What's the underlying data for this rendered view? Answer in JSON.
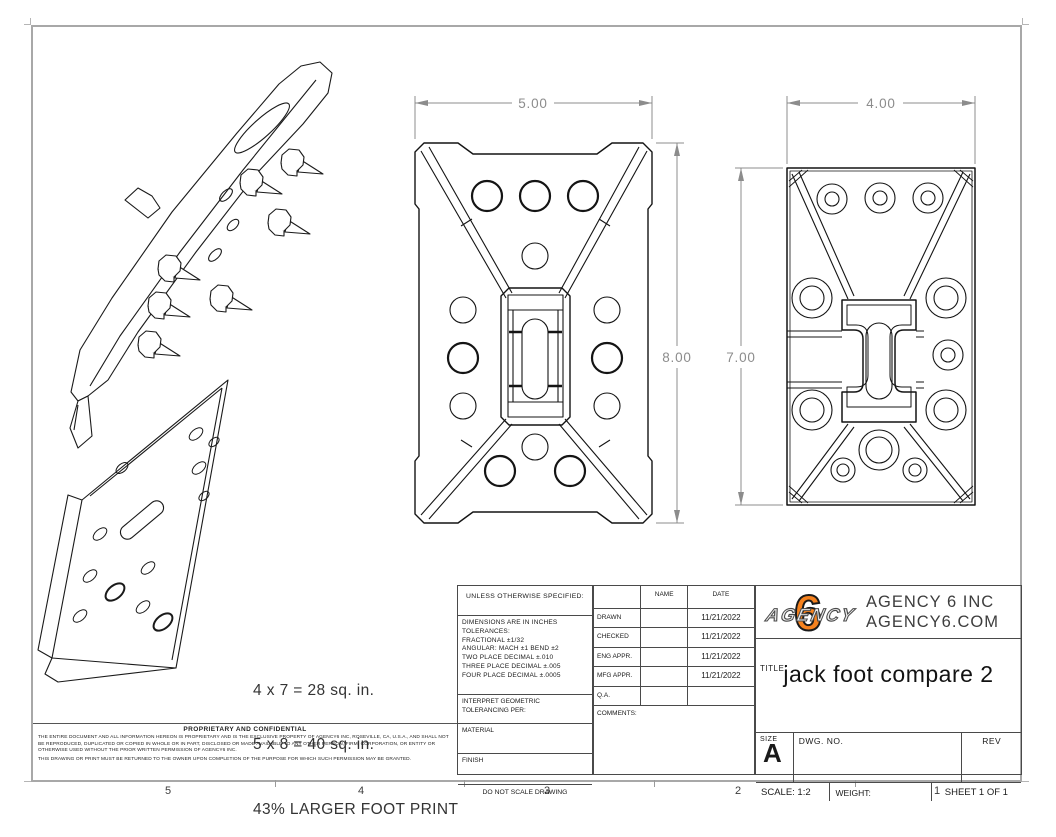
{
  "sheet": {
    "zones": [
      "5",
      "4",
      "3",
      "2",
      "1"
    ]
  },
  "dimensions": {
    "front_width": "5.00",
    "front_height": "8.00",
    "side_width": "4.00",
    "side_height": "7.00"
  },
  "annotations": {
    "line1": "4 x 7 = 28 sq. in.",
    "line2": "5 x 8 = 40 sq. in.",
    "line3": "43% LARGER FOOT PRINT"
  },
  "proprietary": {
    "title": "PROPRIETARY AND CONFIDENTIAL",
    "para1": "THE ENTIRE DOCUMENT AND ALL INFORMATION HEREON IS PROPRIETARY AND IS THE EXCLUSIVE PROPERTY OF AGENCY6 INC, ROSEVILLE, CA, U.S.A., AND SHALL NOT BE REPRODUCED, DUPLICATED OR COPIED IN WHOLE OR IN PART, DISCLOSED OR MADE AVAILABLE TO ANY OTHER PERSON, FIRM, CORPORATION, OR ENTITY OR OTHERWISE USED WITHOUT THE PRIOR WRITTEN PERMISSION OF AGENCY6 INC.",
    "para2": "THIS DRAWING OR PRINT MUST BE RETURNED TO THE OWNER UPON COMPLETION OF THE PURPOSE FOR WHICH SUCH PERMISSION MAY BE GRANTED."
  },
  "tolerance_block": {
    "header": "UNLESS OTHERWISE SPECIFIED:",
    "line1": "DIMENSIONS ARE IN INCHES",
    "line2": "TOLERANCES:",
    "line3": "FRACTIONAL ±1/32",
    "line4": "ANGULAR: MACH ±1   BEND ±2",
    "line5": "TWO PLACE DECIMAL    ±.010",
    "line6": "THREE PLACE DECIMAL  ±.005",
    "line7": "FOUR PLACE DECIMAL  ±.0005",
    "interpret1": "INTERPRET GEOMETRIC",
    "interpret2": "TOLERANCING PER:",
    "material_label": "MATERIAL",
    "finish_label": "FINISH",
    "do_not_scale": "DO NOT SCALE DRAWING"
  },
  "approval_table": {
    "name_header": "NAME",
    "date_header": "DATE",
    "rows": [
      {
        "label": "DRAWN",
        "name": "",
        "date": "11/21/2022"
      },
      {
        "label": "CHECKED",
        "name": "",
        "date": "11/21/2022"
      },
      {
        "label": "ENG APPR.",
        "name": "",
        "date": "11/21/2022"
      },
      {
        "label": "MFG APPR.",
        "name": "",
        "date": "11/21/2022"
      },
      {
        "label": "Q.A.",
        "name": "",
        "date": ""
      }
    ],
    "comments_label": "COMMENTS:"
  },
  "title_block": {
    "logo_number": "6",
    "logo_word": "AGENCY",
    "logo_orange": "#F5821F",
    "company_line1": "AGENCY 6 INC",
    "company_line2": "AGENCY6.COM",
    "title_label": "TITLE:",
    "title": "jack foot compare 2",
    "size_label": "SIZE",
    "size_value": "A",
    "dwg_label": "DWG.  NO.",
    "rev_label": "REV",
    "scale_label": "SCALE: 1:2",
    "weight_label": "WEIGHT:",
    "sheet_label": "SHEET 1 OF 1"
  }
}
